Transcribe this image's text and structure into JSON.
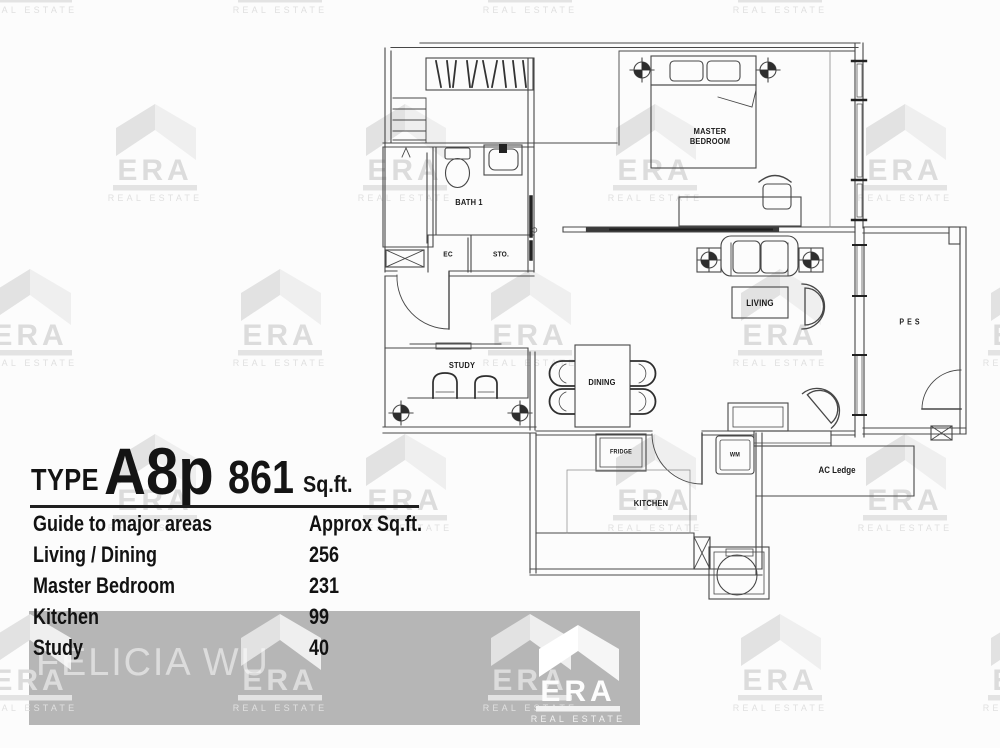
{
  "header": {
    "type_label": "TYPE",
    "unit_type": "A8p",
    "area": "861",
    "area_unit": "Sq.ft."
  },
  "table": {
    "col1_header": "Guide to major areas",
    "col2_header": "Approx Sq.ft.",
    "rows": [
      [
        "Living / Dining",
        "256"
      ],
      [
        "Master Bedroom",
        "231"
      ],
      [
        "Kitchen",
        "99"
      ],
      [
        "Study",
        "40"
      ]
    ]
  },
  "floorplan": {
    "rooms": {
      "master_bedroom": "MASTER\nBEDROOM",
      "bath1": "BATH 1",
      "ec": "EC",
      "sto": "STO.",
      "study": "STUDY",
      "dining": "DINING",
      "living": "LIVING",
      "pes": "PES",
      "kitchen": "KITCHEN",
      "fridge": "FRIDGE",
      "wm": "WM",
      "ac_ledge": "AC Ledge"
    }
  },
  "watermark": {
    "brand": "ERA",
    "tagline": "REAL ESTATE"
  },
  "agent_name": "FELICIA WU"
}
